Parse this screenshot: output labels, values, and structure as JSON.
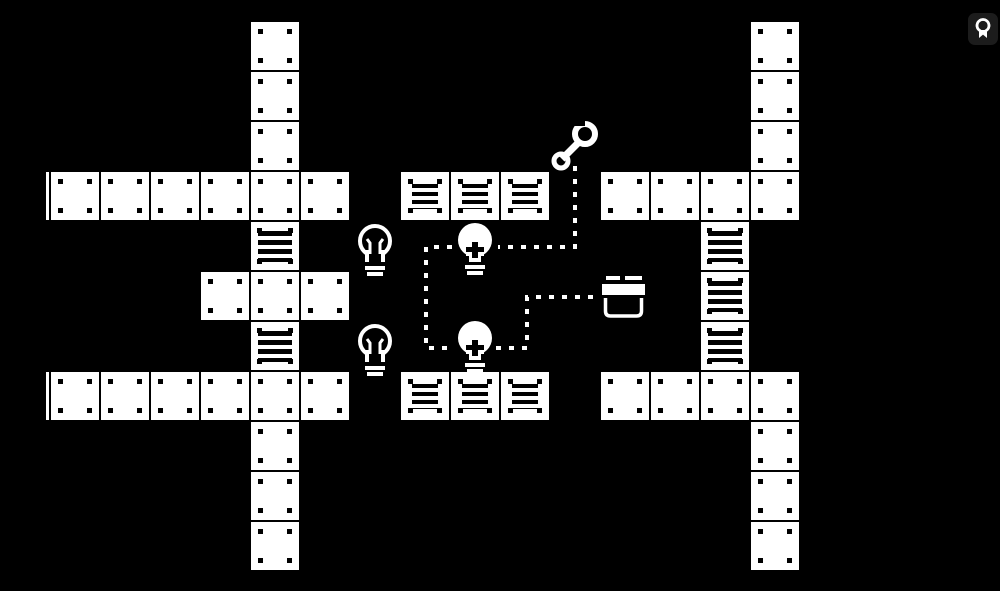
{
  "meta": {
    "background_color": "#000000",
    "foreground_color": "#ffffff",
    "scene": "monochrome-pixel-puzzle-board"
  },
  "hud": {
    "medal_button": {
      "icon": "medal-icon"
    }
  },
  "board": {
    "origin": {
      "x": 1,
      "y": 22
    },
    "pitch": 50,
    "tile_size": 48,
    "tiles": [
      {
        "col": 5,
        "row": 0,
        "type": "plain"
      },
      {
        "col": 5,
        "row": 1,
        "type": "plain"
      },
      {
        "col": 5,
        "row": 2,
        "type": "plain"
      },
      {
        "col": 1,
        "row": 3,
        "type": "plain"
      },
      {
        "col": 2,
        "row": 3,
        "type": "plain"
      },
      {
        "col": 3,
        "row": 3,
        "type": "plain"
      },
      {
        "col": 4,
        "row": 3,
        "type": "plain"
      },
      {
        "col": 5,
        "row": 3,
        "type": "plain"
      },
      {
        "col": 6,
        "row": 3,
        "type": "plain"
      },
      {
        "col": 5,
        "row": 4,
        "type": "crate"
      },
      {
        "col": 4,
        "row": 5,
        "type": "plain"
      },
      {
        "col": 5,
        "row": 5,
        "type": "plain"
      },
      {
        "col": 6,
        "row": 5,
        "type": "plain"
      },
      {
        "col": 5,
        "row": 6,
        "type": "crate"
      },
      {
        "col": 1,
        "row": 7,
        "type": "plain"
      },
      {
        "col": 2,
        "row": 7,
        "type": "plain"
      },
      {
        "col": 3,
        "row": 7,
        "type": "plain"
      },
      {
        "col": 4,
        "row": 7,
        "type": "plain"
      },
      {
        "col": 5,
        "row": 7,
        "type": "plain"
      },
      {
        "col": 6,
        "row": 7,
        "type": "plain"
      },
      {
        "col": 5,
        "row": 8,
        "type": "plain"
      },
      {
        "col": 5,
        "row": 9,
        "type": "plain"
      },
      {
        "col": 5,
        "row": 10,
        "type": "plain"
      },
      {
        "col": 8,
        "row": 3,
        "type": "vent"
      },
      {
        "col": 9,
        "row": 3,
        "type": "vent"
      },
      {
        "col": 10,
        "row": 3,
        "type": "vent"
      },
      {
        "col": 8,
        "row": 7,
        "type": "vent"
      },
      {
        "col": 9,
        "row": 7,
        "type": "vent"
      },
      {
        "col": 10,
        "row": 7,
        "type": "vent"
      },
      {
        "col": 15,
        "row": 0,
        "type": "plain"
      },
      {
        "col": 15,
        "row": 1,
        "type": "plain"
      },
      {
        "col": 15,
        "row": 2,
        "type": "plain"
      },
      {
        "col": 12,
        "row": 3,
        "type": "plain"
      },
      {
        "col": 13,
        "row": 3,
        "type": "plain"
      },
      {
        "col": 14,
        "row": 3,
        "type": "plain"
      },
      {
        "col": 15,
        "row": 3,
        "type": "plain"
      },
      {
        "col": 14,
        "row": 4,
        "type": "crate"
      },
      {
        "col": 14,
        "row": 5,
        "type": "crate"
      },
      {
        "col": 14,
        "row": 6,
        "type": "crate"
      },
      {
        "col": 12,
        "row": 7,
        "type": "plain"
      },
      {
        "col": 13,
        "row": 7,
        "type": "plain"
      },
      {
        "col": 14,
        "row": 7,
        "type": "plain"
      },
      {
        "col": 15,
        "row": 7,
        "type": "plain"
      },
      {
        "col": 15,
        "row": 8,
        "type": "plain"
      },
      {
        "col": 15,
        "row": 9,
        "type": "plain"
      },
      {
        "col": 15,
        "row": 10,
        "type": "plain"
      }
    ],
    "edge_slivers": [
      {
        "x": 46,
        "y": 172
      },
      {
        "x": 46,
        "y": 372
      }
    ],
    "objects": [
      {
        "type": "bulb-off",
        "x": 353,
        "y": 222
      },
      {
        "type": "bulb-off",
        "x": 353,
        "y": 322
      },
      {
        "type": "bulb-on",
        "x": 453,
        "y": 220
      },
      {
        "type": "bulb-on",
        "x": 453,
        "y": 318
      },
      {
        "type": "wrench",
        "x": 550,
        "y": 115
      },
      {
        "type": "toolbox",
        "x": 600,
        "y": 270
      }
    ],
    "wires": [
      {
        "points": [
          [
            575,
            166
          ],
          [
            575,
            247
          ],
          [
            498,
            247
          ]
        ]
      },
      {
        "points": [
          [
            452,
            247
          ],
          [
            426,
            247
          ],
          [
            426,
            348
          ],
          [
            452,
            348
          ]
        ]
      },
      {
        "points": [
          [
            496,
            348
          ],
          [
            527,
            348
          ],
          [
            527,
            297
          ],
          [
            600,
            297
          ]
        ]
      }
    ]
  }
}
